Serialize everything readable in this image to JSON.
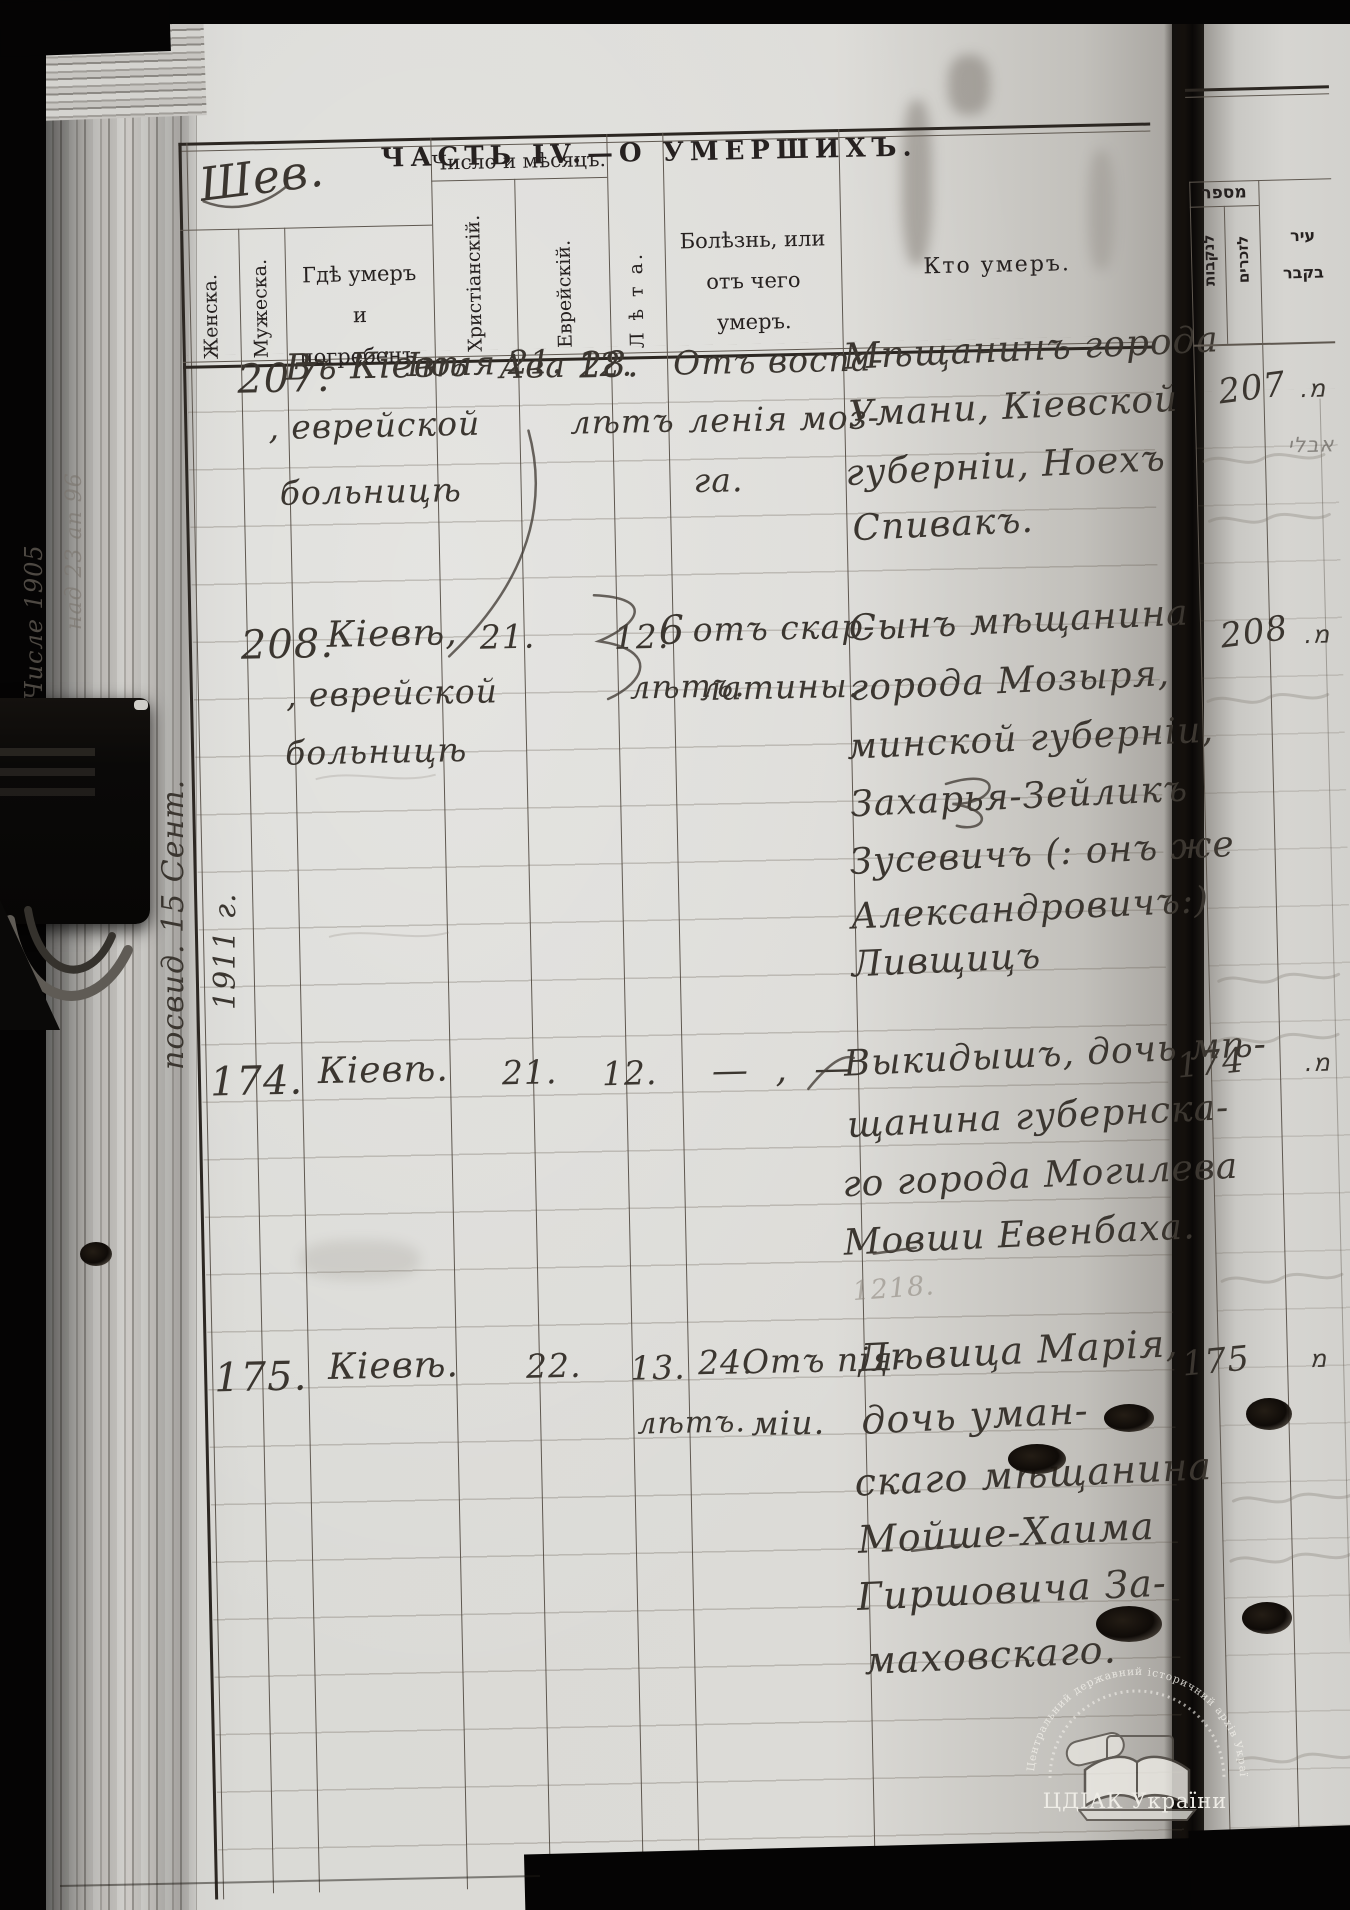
{
  "photo": {
    "watermark": {
      "arc_text": "Центральний державний історичний архів України, м. Київ",
      "label": "ЦДІАК України"
    }
  },
  "marginalia": {
    "top_mark": "Шев.",
    "side_note_line1": "посвид. 15 Сент.",
    "side_note_line2": "1911 г.",
    "gutter_note_1": "Числе 1905",
    "gutter_note_2": "над 23 ап 96",
    "pencil_note": "1218."
  },
  "table": {
    "title": "ЧАСТЬ IV.—О УМЕРШИХЪ.",
    "columns": {
      "female": "Женска.",
      "male": "Мужеска.",
      "place": [
        "Гдѣ умеръ",
        "и",
        "погребенъ."
      ],
      "date_group": "Число и мѣсяцъ.",
      "christian": "Христіанскій.",
      "jewish": "Еврейскій.",
      "age": "Л ѣ т а.",
      "cause": [
        "Болѣзнь, или",
        "отъ чего",
        "умеръ."
      ],
      "who": "Кто умеръ."
    },
    "rows": [
      {
        "num": "207.",
        "place": [
          "Въ Кіевѣ",
          ", еврейской",
          "больницѣ"
        ],
        "christian": "Іюля 21.",
        "jewish": "Ава 12.",
        "age": [
          "28.",
          "лѣтъ"
        ],
        "cause": [
          "Отъ воспа-",
          "ленія моз-",
          "га."
        ],
        "who": [
          "Мѣщанинъ города",
          "Умани, Кіевской",
          "губерніи, Ноехъ",
          "Спивакъ."
        ]
      },
      {
        "num": "208.",
        "place": [
          "Кіевѣ,",
          ", еврейской",
          "больницѣ"
        ],
        "christian": "21.",
        "jewish": "12.",
        "age": [
          "6",
          "лѣтъ."
        ],
        "cause": [
          "отъ скар-",
          "латины."
        ],
        "who": [
          "Сынъ мѣщанина",
          "города Мозыря,",
          "минской губерніи,",
          "Захарья-Зейликъ",
          "Зусевичъ (: онъ же",
          "Александровичъ:)",
          "Ливщицъ"
        ]
      },
      {
        "num": "174.",
        "place": [
          "Кіевѣ."
        ],
        "christian": "21.",
        "jewish": "12.",
        "age": [],
        "cause": [
          "— , —"
        ],
        "who": [
          "Выкидышъ, дочь мѣ-",
          "щанина губернска-",
          "го города Могилева",
          "Мовши Евенбаха."
        ]
      },
      {
        "num": "175.",
        "place": [
          "Кіевѣ."
        ],
        "christian": "22.",
        "jewish": "13.",
        "age": [
          "24.",
          "лѣтъ."
        ],
        "cause": [
          "Отъ пія-",
          "міи."
        ],
        "who": [
          "Дѣвица Марія,",
          "дочь уман-",
          "скаго мѣщанина",
          "Мойше-Хаима",
          "Гиршовича За-",
          "маховскаго."
        ]
      }
    ]
  },
  "right_page": {
    "number_header": "מספר",
    "col_female": "לנקבות",
    "col_male": "לזכרים",
    "city_header_line1": "עיר",
    "city_header_line2": "בקבר",
    "entries": [
      {
        "num": "207",
        "mark": "מ.",
        "note": "אבלי"
      },
      {
        "num": "208",
        "mark": "מ."
      },
      {
        "num": "174",
        "mark": "מ."
      },
      {
        "num": "175",
        "mark": "מ"
      }
    ]
  }
}
